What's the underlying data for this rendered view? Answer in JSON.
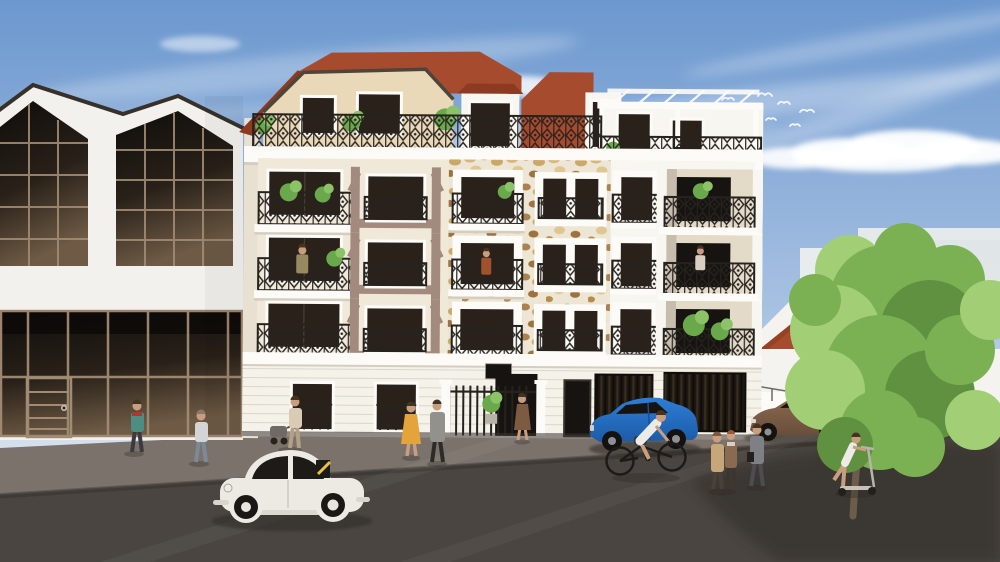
{
  "image": {
    "type": "architectural-3d-rendering",
    "subject": "Street elevation rendering of a five-storey cream apartment building with wrought-iron balconies, stone-clad bays, mansard roof and roof-terrace pergola, flanked by a glass-gable warehouse and a red-roofed house, with pedestrians, a cyclist, a scooter rider, a white classic beetle, a blue hatchback and a brown sedan on a sunny street",
    "setting": "sunny day, blue sky with wispy clouds"
  },
  "entities": {
    "buildings": [
      "glass-gable warehouse (left)",
      "five-storey apartment building (center)",
      "white house with red hip roof (right)",
      "hazy background blocks (far right)"
    ],
    "building_features": [
      "mansard roof",
      "roof terrace with white pergola",
      "ornamental iron balcony railings",
      "stone-clad window bays",
      "half-timber taupe accents",
      "entrance gate with spiked iron fence",
      "two dark garage doors",
      "ground-floor windows with iron grilles",
      "dark plaque above entrance"
    ],
    "floors": 5,
    "vehicles": [
      {
        "type": "classic beetle car",
        "color_key": "beetle_white"
      },
      {
        "type": "hatchback car",
        "color_key": "car_blue"
      },
      {
        "type": "sedan car",
        "color_key": "car_brown"
      },
      {
        "type": "bicycle"
      },
      {
        "type": "kick scooter"
      }
    ],
    "people": [
      "woman in teal jacket",
      "person in grey hoodie",
      "adult pushing stroller",
      "woman in yellow dress",
      "man in grey coat",
      "woman in brown dress",
      "resident on left balcony",
      "resident on stone-bay balcony",
      "resident on right loggia",
      "cyclist in white shirt",
      "couple walking",
      "man in grey suit",
      "woman on kick scooter"
    ],
    "birds_count": 7,
    "nature": [
      "large street tree",
      "balcony plants",
      "potted plant at entrance"
    ],
    "street": [
      "sidewalk",
      "asphalt road",
      "tree shadow bottom right"
    ]
  },
  "colors": {
    "sky_top": "#6c98cf",
    "sky_mid": "#a8c1e2",
    "sky_horizon": "#e9edf2",
    "cloud": "#ffffff",
    "warehouse_white": "#f2f1ee",
    "fascia_dark": "#37312b",
    "glass_top": "#0f0d0b",
    "glass_mid": "#292119",
    "glass_bottom": "#6e5a45",
    "mullion": "#a28b73",
    "facade_cream": "#f0e9da",
    "facade_white": "#f8f6f0",
    "mansard_cream": "#ead9b9",
    "trim_white": "#fcfbf7",
    "cornice_shadow": "#d5cec0",
    "timber_taupe": "#a28a7e",
    "stone_mortar": "#eee6d4",
    "stone_tan": "#d7b67a",
    "stone_brown": "#aa8150",
    "roof_red": "#a74b2f",
    "roof_red_dark": "#8c3a22",
    "window_dark": "#2a221a",
    "window_black": "#171310",
    "railing_dark": "#26221e",
    "interior_shade": "#e4dac8",
    "garage_dark": "#1b1610",
    "road": "#4a4540",
    "sidewalk": "#7b726b",
    "shadow": "#2d2926",
    "tree_green": "#7cb153",
    "tree_green_light": "#a2cf76",
    "tree_green_dark": "#5f9140",
    "tree_trunk": "#6c5d4a",
    "plant_green": "#69a94c",
    "plant_green_light": "#8dc368",
    "beetle_white": "#edeae4",
    "car_blue": "#2e7ed7",
    "car_blue_dark": "#1c5ba6",
    "car_brown": "#8b6a52",
    "car_brown_dark": "#684e3a",
    "skin": "#c99d7f",
    "hair": "#44331f",
    "bird_white": "#f4f6f9",
    "house_white": "#f4f3ef",
    "haze_white": "#edf0ee",
    "p_teal": "#4e8d84",
    "p_hoodie": "#d3d4d6",
    "p_jeans": "#7c8a96",
    "p_yellow": "#e5a33c",
    "p_coat_grey": "#93918c",
    "p_dress_brown": "#7d5a42",
    "p_tan_coat": "#c7a67a",
    "p_brown_coat": "#8a6a50",
    "p_suit": "#7e8085",
    "p_white": "#ecebe7",
    "p_olive": "#988a60",
    "p_rust": "#a0522d",
    "p_light": "#d8cfc2",
    "p_beige": "#d9cbb4",
    "p_khaki": "#b4a185",
    "scarf_red": "#a43b34"
  }
}
